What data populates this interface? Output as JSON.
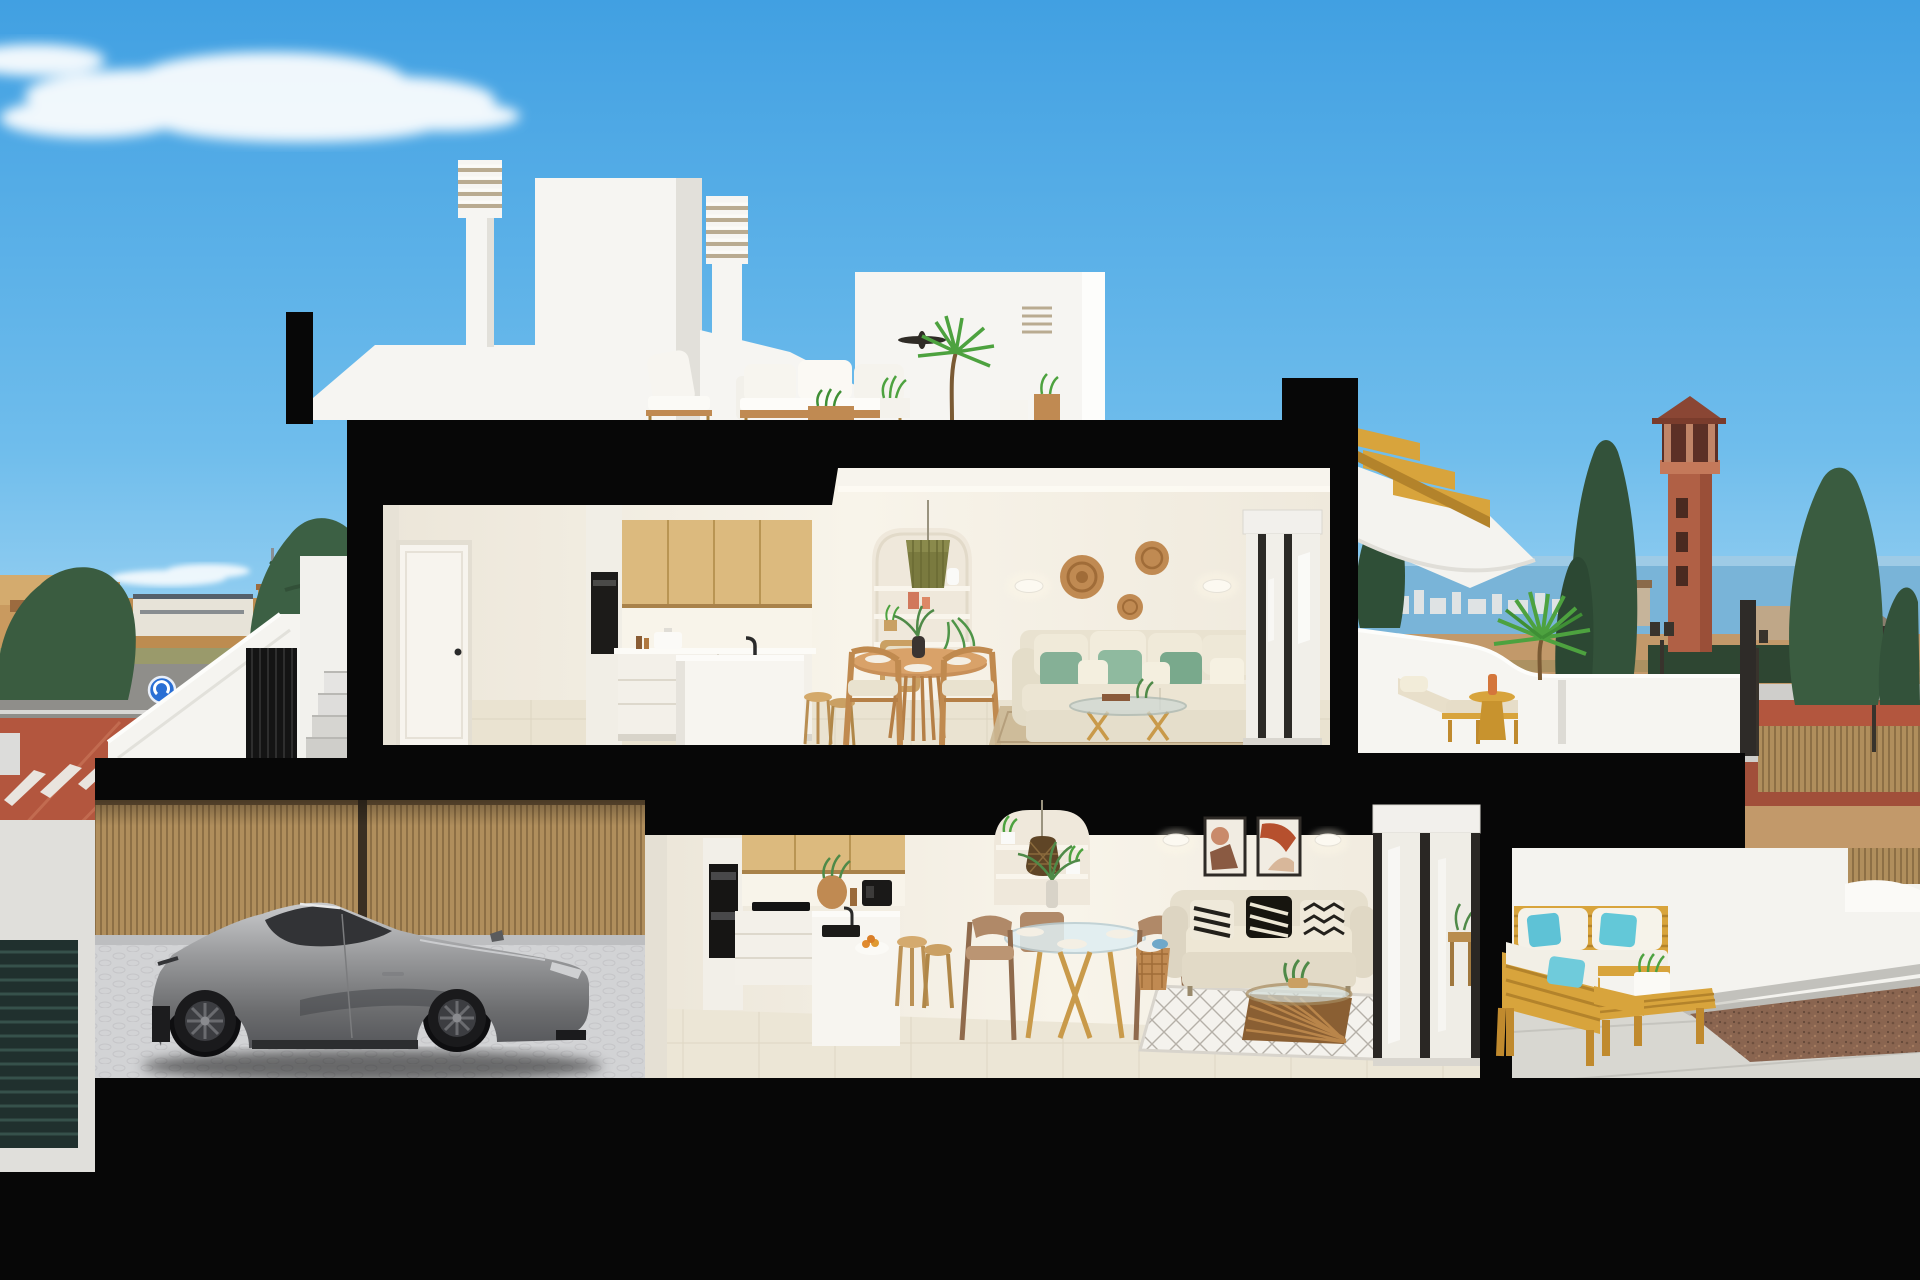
{
  "colors": {
    "sky_top": "#41a0e2",
    "sky_mid": "#6fbdec",
    "sky_low": "#a6d7f3",
    "sky_horizon": "#cdeaf8",
    "cloud": "#ffffff",
    "cut_black": "#070707",
    "wall_white": "#f6f5f2",
    "wall_shadow": "#e2e0da",
    "wall_warm": "#f3eee4",
    "wall_warm_lit": "#faf6ec",
    "floor_tile": "#eae3d1",
    "floor_tile_lower": "#ece6d6",
    "terrace_floor": "#e0ddd5",
    "wood_cabinet": "#dcba7e",
    "wood_gold": "#d8a43c",
    "wood_warm": "#c08a4f",
    "sofa_cream": "#ebe4d2",
    "cushion_green": "#85b096",
    "cushion_teal": "#5ec2d6",
    "rattan": "#c08a52",
    "car_silver": "#a7a8aa",
    "car_glass": "#323336",
    "wheel_dark": "#1a1a1c",
    "fence_wood": "#b08e5c",
    "fence_wood_dark": "#8d6f45",
    "town_wall": "#c99a5f",
    "town_roof": "#9c6b3f",
    "tree_green": "#3a5c40",
    "palm_green": "#4da23f",
    "sea": "#79b4d8",
    "mountain": "#80756a",
    "road_red": "#b3563e",
    "road_gray": "#8f8e8a",
    "sand": "#c2996a",
    "gravel": "#8a6550",
    "tower": "#b06045",
    "sign_blue": "#2a6fd4",
    "art_terracotta": "#b6633f",
    "niche_bg": "#efe8db",
    "pendant_olive": "#7a7a3f",
    "lamp_dark": "#38332c"
  },
  "scene": {
    "type_label": "3D cutaway cross-section rendering of a two-storey coastal townhouse at dusk",
    "labels": {
      "sky": "Blue sky with white clouds",
      "background_left": "Town skyline, trees and street with blue road sign",
      "background_right": "Sea horizon, watchtower, cypress trees and red roads",
      "roofline": "White roof volumes with louvered chimneys and stair bulkhead",
      "roof_terrace": "Roof terrace with white outdoor lounge set and palm plant",
      "section_cut": "Black section-cut slabs and walls",
      "upper_floor": "Upper floor: kitchen, dining area and living room",
      "upper_terrace": "Upper terrace with wooden sun lounger, side table and palm planter",
      "wood_stair": "Golden wood exterior stair to the roof",
      "exterior_stair": "Exterior side staircase with dark louvered gate",
      "garage": "Garage with silver sports car and wooden slat fence",
      "lower_floor": "Ground floor: kitchen, dining area and living room",
      "lower_terrace": "Ground-floor terrace with golden wood garden sofas and teal pillows"
    }
  }
}
